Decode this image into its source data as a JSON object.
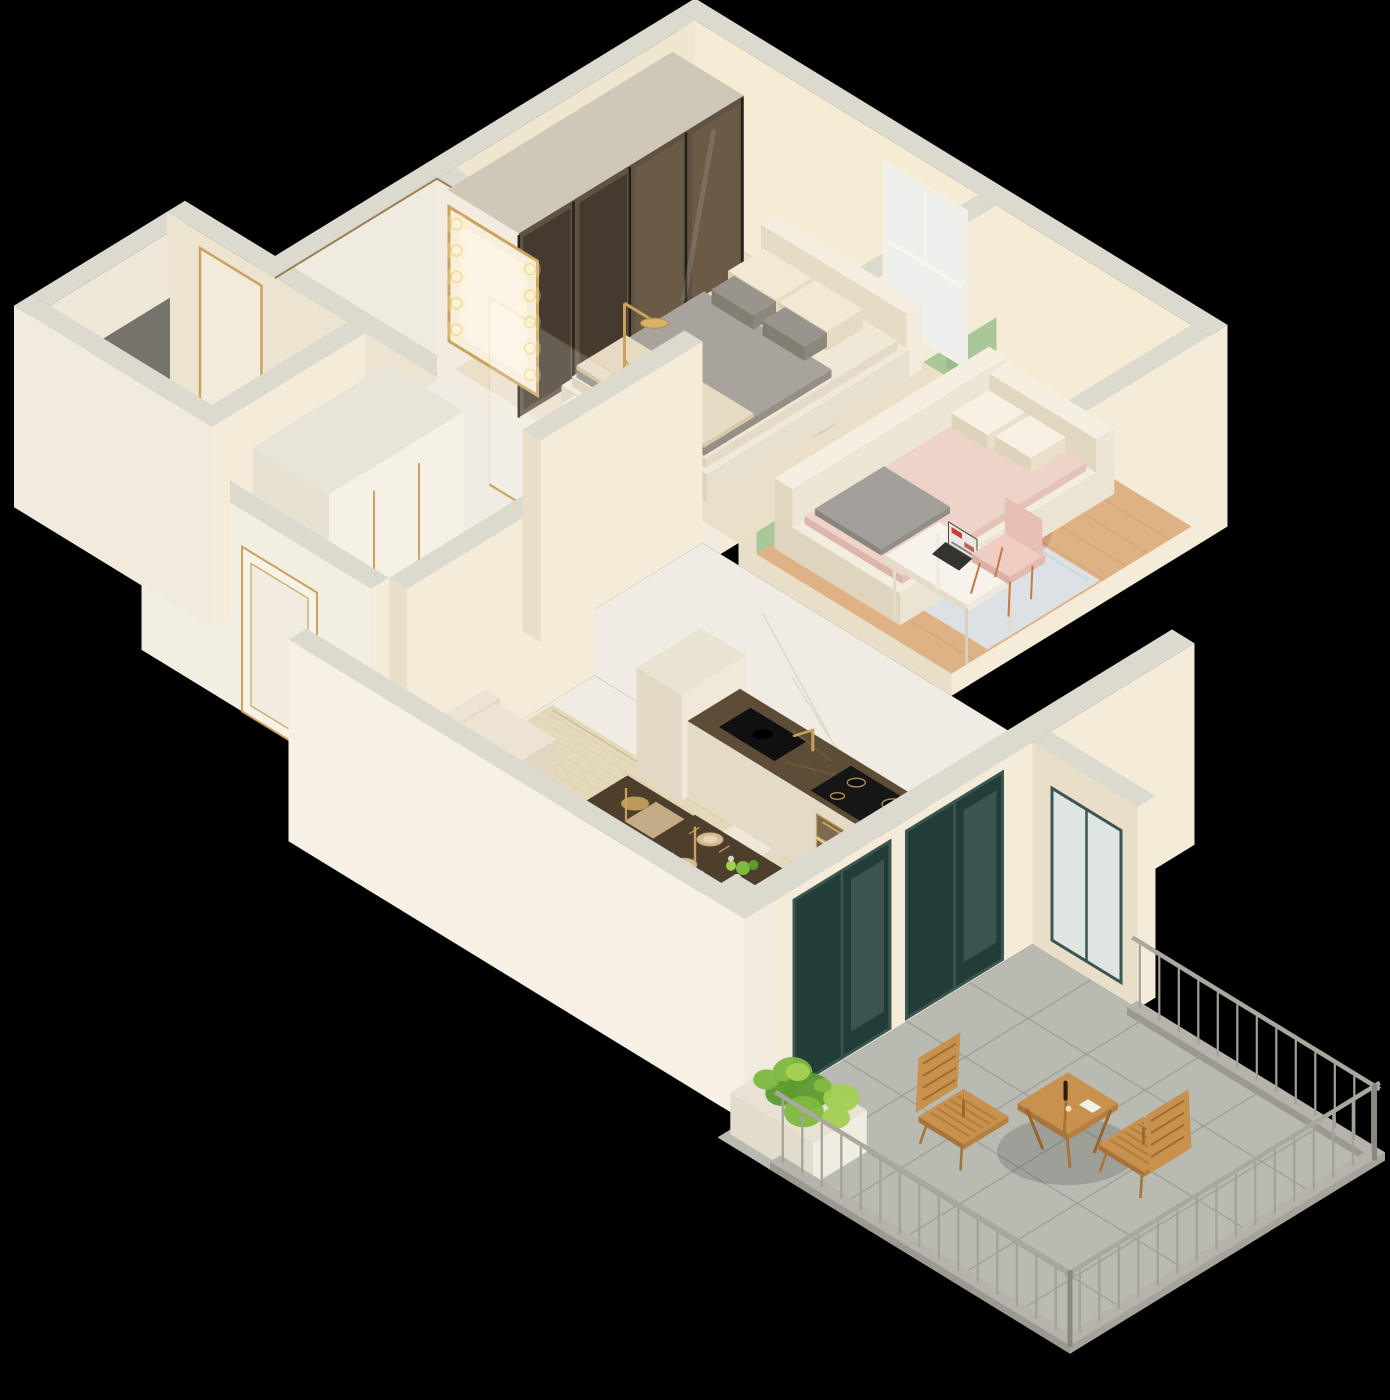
{
  "meta": {
    "title": "3D Isometric Apartment Floor Plan Render",
    "description": "Cutaway 3D isometric render of a one-bedroom apartment on a black background: bedroom with smoked-glass wardrobe and bed, kids room with tufted daybed, desk, laptop and pink chair, marble bathroom with Hollywood mirror and gold rain shower, WC with wall-hung toilet, hallway wardrobe and entry door, open living room with beige sofa, gold coffee table, marble dining table with four chairs, kitchen run with dark marble counter, sink, gold faucet and induction hob, and a tiled balcony with steel railing, wooden folding table and chairs and green planters.",
    "background": "#000000",
    "projection": "isometric cutaway"
  },
  "palette": {
    "background": "#000000",
    "wallTop": "#dcd9cf",
    "wallFace": "#f4ecd8",
    "wallFaceShade": "#e9dfc8",
    "wallPeach": "#f6ecd4",
    "marbleFloor": "#f0ece3",
    "marbleVein": "#d8d2c4",
    "woodFloor": "#dfb286",
    "woodLine": "#c69a6c",
    "kidsRug": "#dce4ea",
    "livingRug": "#e5d9bb",
    "rugLine": "#d5c5a2",
    "sofa": "#eae1cf",
    "bedFrame": "#f0e9d9",
    "duvetGrey": "#a8a49d",
    "pillowCream": "#f2e8d4",
    "pillowGrey": "#9a958c",
    "pinkBed": "#eed3c9",
    "white": "#f6f2e7",
    "tableMarble": "#4e3f2d",
    "counterMarble": "#5d4c36",
    "cabinet": "#efe8d9",
    "gold": "#c9a35e",
    "goldDeep": "#b18b46",
    "hobBlack": "#161616",
    "balconyTile": "#b9bab2",
    "grout": "#9b9c94",
    "railing": "#a3a198",
    "woodOutdoor": "#c8914d",
    "woodOutdoorDark": "#a8743a",
    "plantGreen": "#7fb93f",
    "plantGreenDark": "#5d9a2f",
    "plantGreenLight": "#a3cf52",
    "tealFrame": "#3a5650",
    "glassDark": "#223c37",
    "greenWall": "#aac79a",
    "panelGrey": "#75736c",
    "chairPink": "#f0cdc2",
    "copper": "#c07a45",
    "glow": "#ffeebb"
  },
  "counts": {
    "mirror_bulbs_per_side": 5,
    "hob_burners": 4,
    "dining_chairs": 4,
    "dining_place_settings": 4,
    "balcony_chairs": 2,
    "glass_door_panels": 2,
    "wardrobe_glass_panels": 4
  },
  "rooms": [
    {
      "id": "bedroom",
      "label": "Bedroom",
      "furniture": [
        "double-bed",
        "headboard",
        "grey-duvet",
        "pillows",
        "smoked-glass-wardrobe",
        "window",
        "foot-bench"
      ]
    },
    {
      "id": "kids-room",
      "label": "Kids Room / Study",
      "furniture": [
        "tufted-daybed",
        "pink-duvet",
        "patterned-pillows",
        "grey-throw",
        "green-accent-wall",
        "desk",
        "laptop",
        "pink-chair",
        "pale-blue-rug",
        "wood-floor"
      ]
    },
    {
      "id": "bathroom",
      "label": "Bathroom",
      "furniture": [
        "hollywood-mirror-with-bulbs",
        "gold-pedestal-basin",
        "gold-rain-shower",
        "glass-shower-screen",
        "marble-walls"
      ]
    },
    {
      "id": "wc",
      "label": "WC",
      "furniture": [
        "wall-hung-toilet",
        "grey-flush-panel",
        "gold-flush-plate",
        "mini-basin-stool",
        "gold-framed-mirror-panel"
      ]
    },
    {
      "id": "hallway",
      "label": "Hallway / Entry",
      "furniture": [
        "white-wardrobe-gold-handles",
        "entry-door-gold-trim",
        "marble-floor"
      ]
    },
    {
      "id": "living-room",
      "label": "Living Room",
      "furniture": [
        "corner-sofa",
        "beige-area-rug",
        "marble-gold-coffee-table"
      ]
    },
    {
      "id": "dining-area",
      "label": "Dining Area",
      "furniture": [
        "dark-marble-dining-table",
        "four-cream-chairs",
        "place-settings",
        "plant-centerpiece"
      ]
    },
    {
      "id": "kitchen",
      "label": "Kitchen",
      "furniture": [
        "dark-marble-counter",
        "black-sink",
        "gold-faucet",
        "induction-hob",
        "oven-drawers",
        "tall-cabinet"
      ]
    },
    {
      "id": "balcony",
      "label": "Balcony",
      "furniture": [
        "steel-railing",
        "grey-tile-floor",
        "wooden-folding-table",
        "two-wooden-chairs",
        "wine-bottle",
        "planter-boxes",
        "green-plants",
        "glass-doors"
      ]
    }
  ]
}
